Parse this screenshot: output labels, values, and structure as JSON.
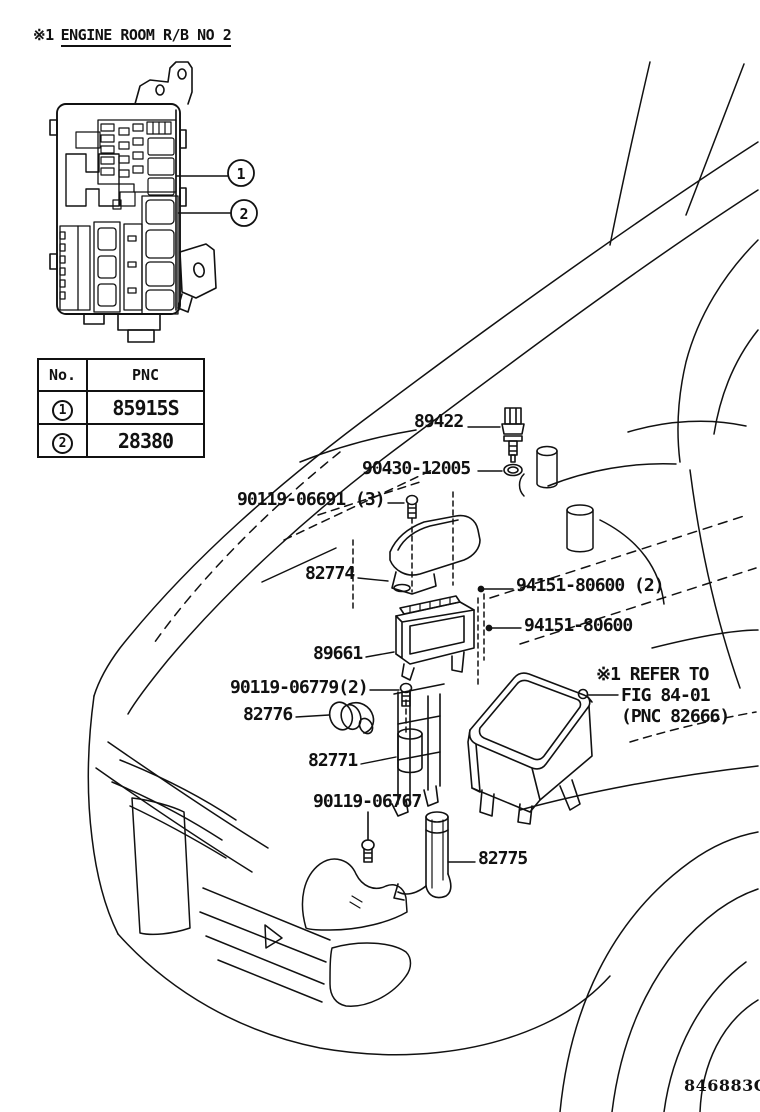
{
  "header": {
    "ref_mark": "※1",
    "title": "ENGINE ROOM R/B NO 2"
  },
  "fusebox_table": {
    "col_no": "No.",
    "col_pnc": "PNC",
    "rows": [
      {
        "no": "1",
        "pnc": "85915S"
      },
      {
        "no": "2",
        "pnc": "28380"
      }
    ]
  },
  "callouts": [
    {
      "num": "1"
    },
    {
      "num": "2"
    }
  ],
  "part_labels": {
    "sensor": "89422",
    "gasket": "90430-12005",
    "bolt_cover": "90119-06691 (3)",
    "cover": "82774",
    "screw_pair": "94151-80600 (2)",
    "screw_single": "94151-80600",
    "ecu": "89661",
    "bolt_ecu": "90119-06779(2)",
    "grommet": "82776",
    "bracket": "82771",
    "bolt_duct": "90119-06767",
    "duct": "82775"
  },
  "note": {
    "line1": "※1 REFER TO",
    "line2": "FIG 84-01",
    "line3": "(PNC 82666)"
  },
  "footer": {
    "code": "846883G"
  },
  "colors": {
    "ink": "#111111",
    "background": "#ffffff"
  }
}
